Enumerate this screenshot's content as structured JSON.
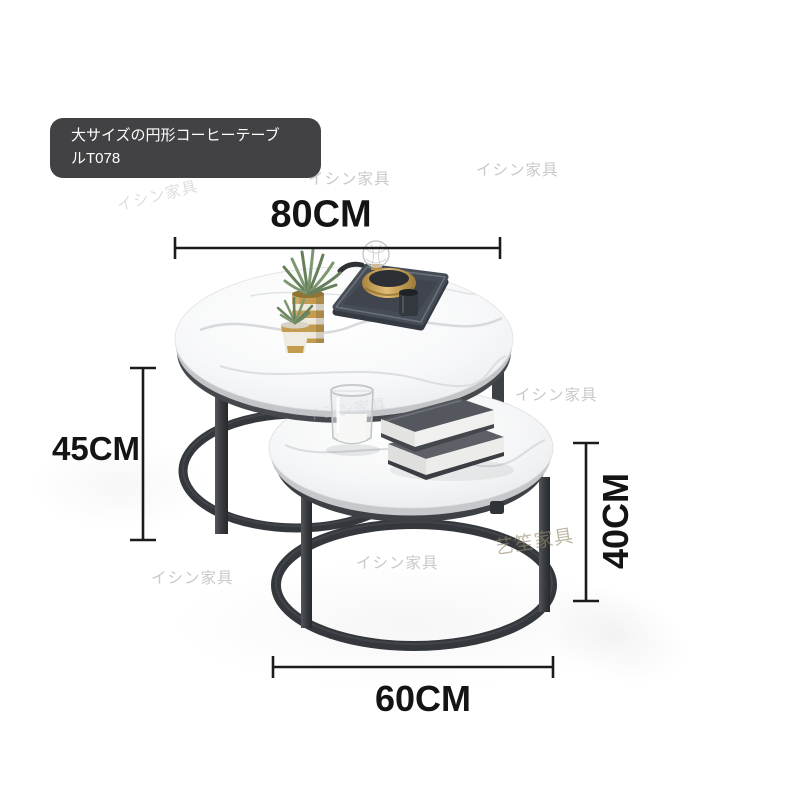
{
  "product_label": {
    "line1": "大サイズの円形コーヒーテーブ",
    "line2": "ルT078"
  },
  "dimensions": {
    "top_diameter": "80CM",
    "large_table_height": "45CM",
    "small_table_height": "40CM",
    "small_table_diameter": "60CM"
  },
  "watermarks": {
    "primary": "イシン家具",
    "secondary": "艺笙家具"
  },
  "colors": {
    "dimension_annotation": "#141414",
    "label_background": "#3c3c3e",
    "label_text": "#ffffff",
    "metal_frame": "#35383c",
    "marble_top": "#f6f7f8",
    "gold_accent": "#c39c50",
    "tray": "#474d56",
    "watermark_gray": "#c9c9c9"
  }
}
